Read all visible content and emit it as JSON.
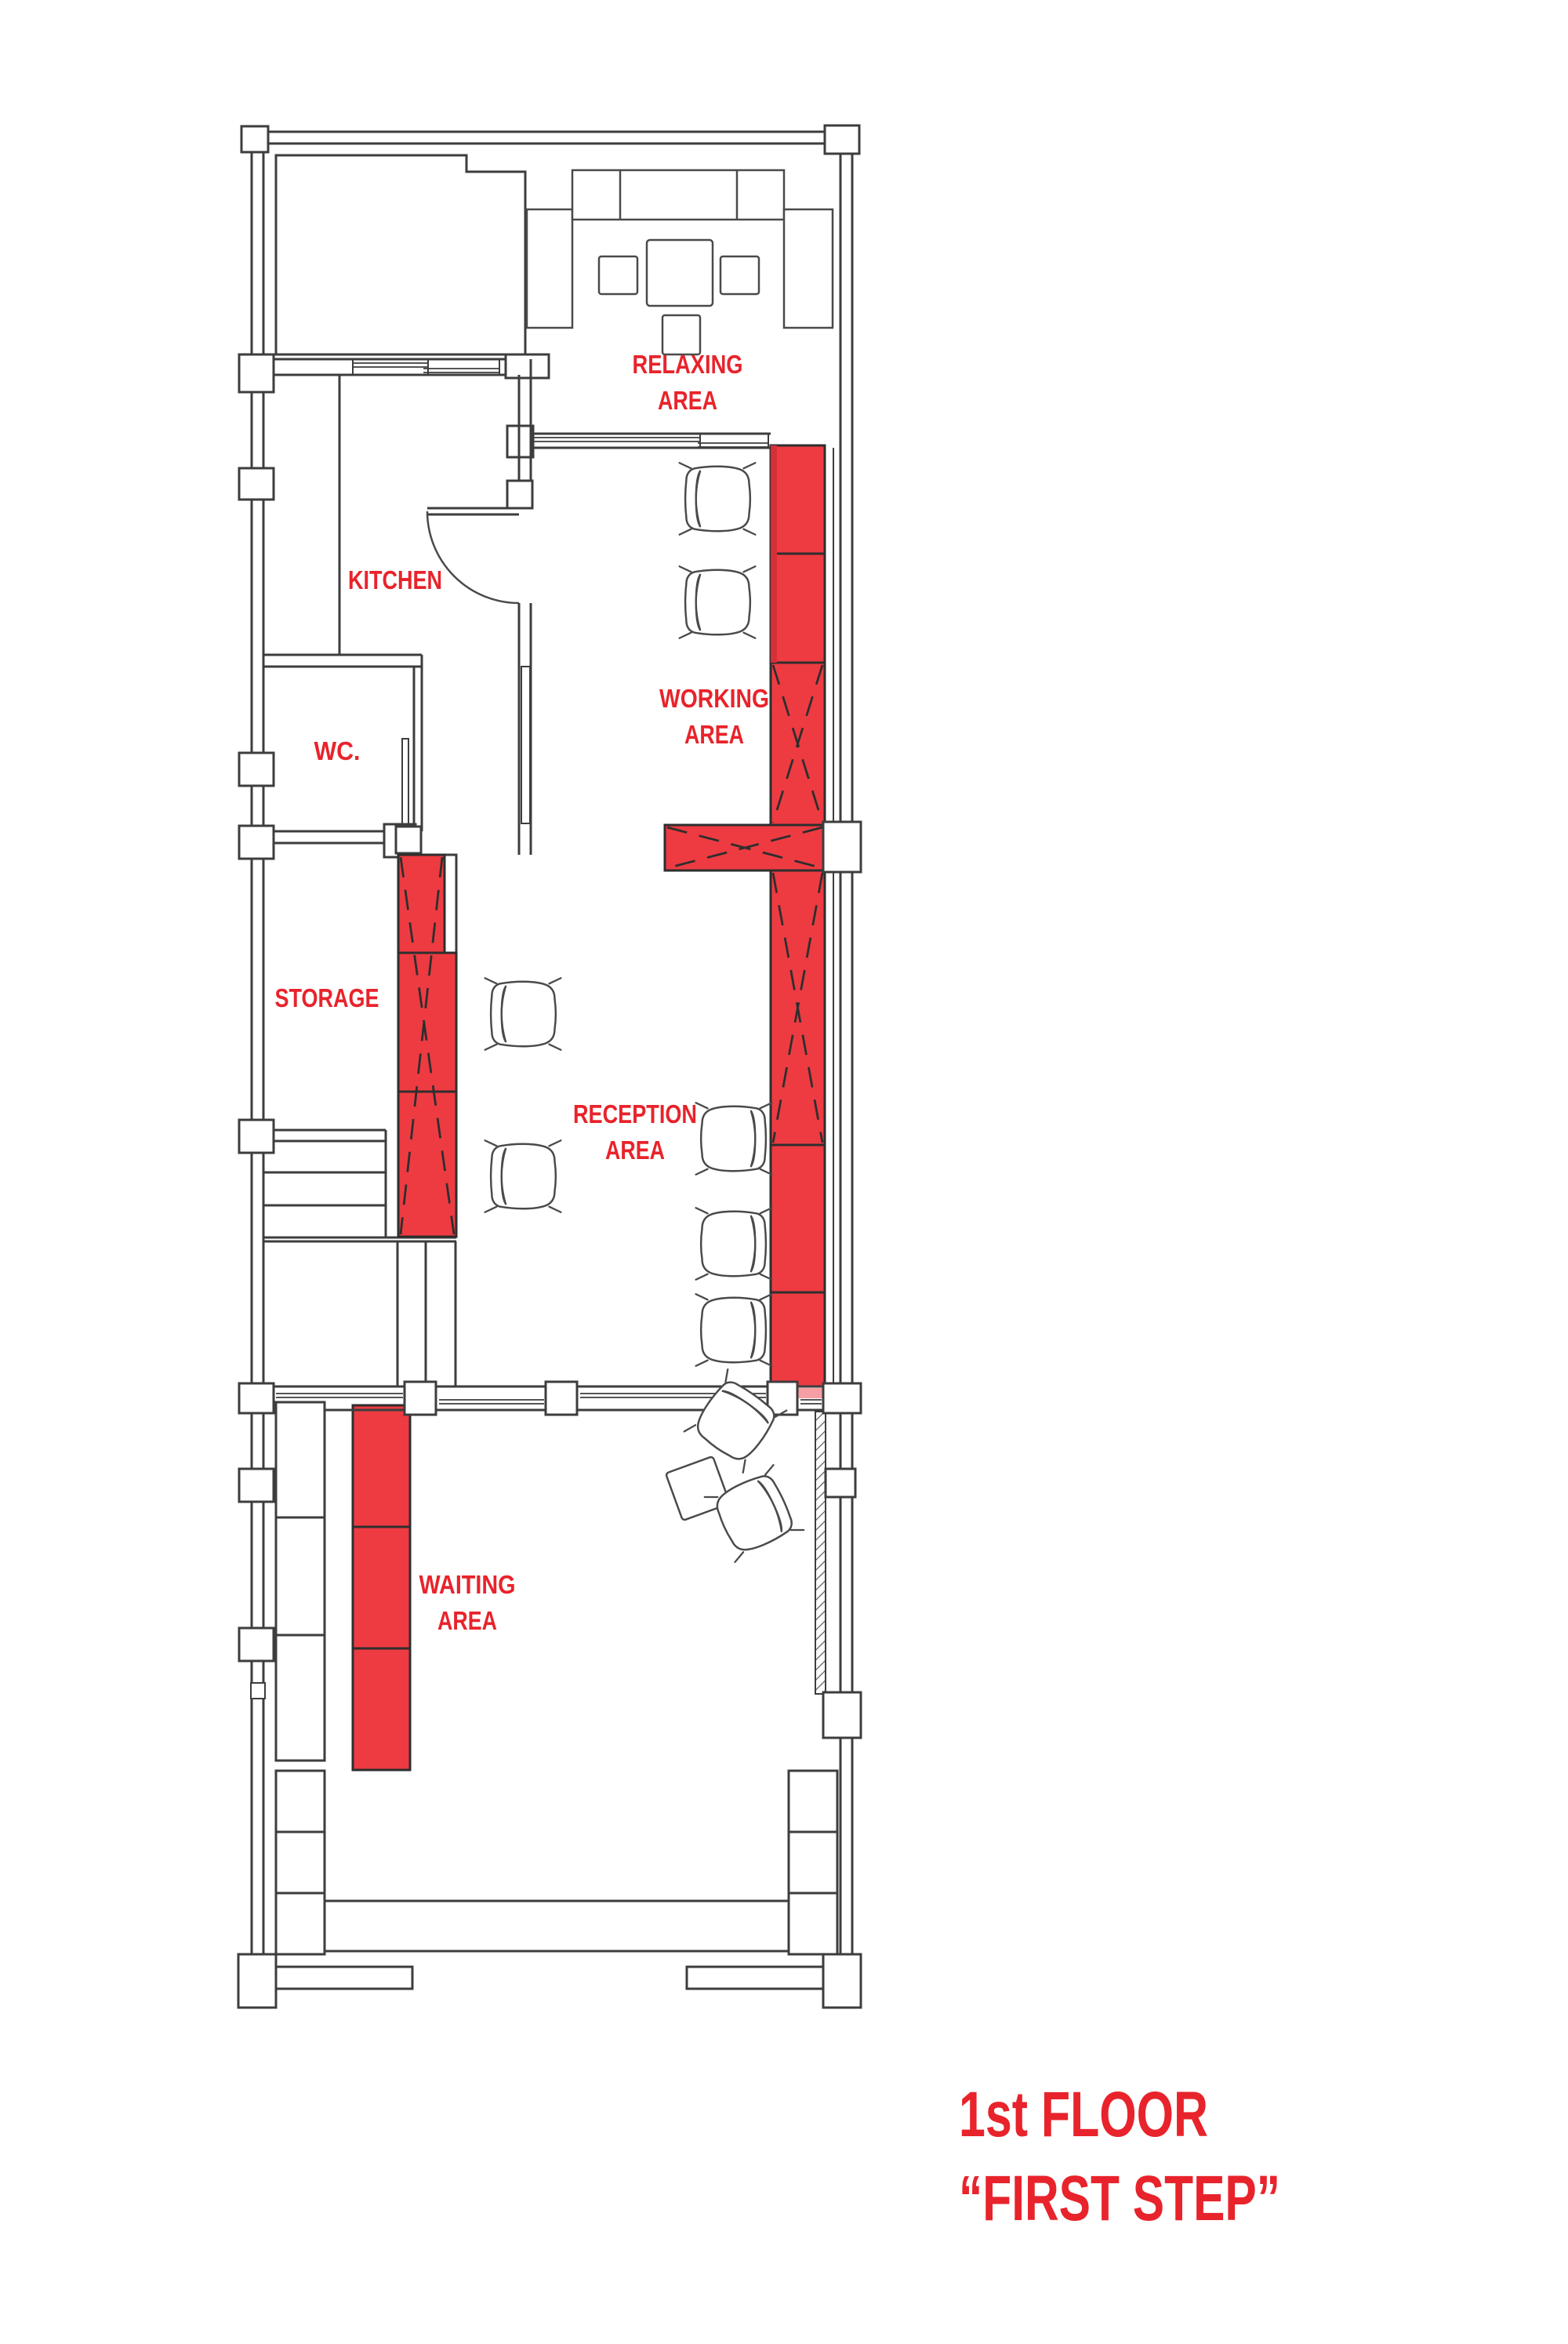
{
  "title": {
    "line1": "1st FLOOR",
    "line2": "“FIRST STEP”"
  },
  "labels": {
    "relaxing": {
      "line1": "RELAXING",
      "line2": "AREA"
    },
    "kitchen": {
      "line1": "KITCHEN"
    },
    "wc": {
      "line1": "WC."
    },
    "working": {
      "line1": "WORKING",
      "line2": "AREA"
    },
    "storage": {
      "line1": "STORAGE"
    },
    "reception": {
      "line1": "RECEPTION",
      "line2": "AREA"
    },
    "waiting": {
      "line1": "WAITING",
      "line2": "AREA"
    }
  },
  "colors": {
    "red": "#ee3b42",
    "red_dark": "#d62f38",
    "red_light": "#f59fa5",
    "accent": "#e8232b",
    "line": "#3d3d3d"
  }
}
